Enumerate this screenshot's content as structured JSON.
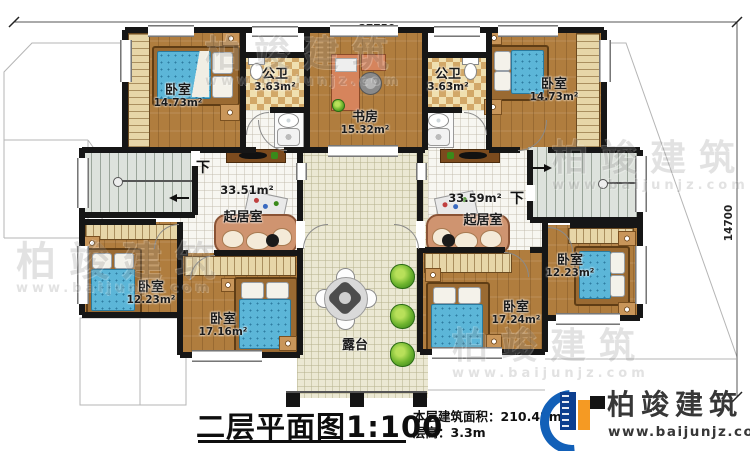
{
  "dimensions": {
    "width_mm": "27750",
    "height_mm": "14700"
  },
  "rooms": {
    "bedroom_top_left": {
      "name": "卧室",
      "area": "14.73m²"
    },
    "bath_left": {
      "name": "公卫",
      "area": "3.63m²"
    },
    "study": {
      "name": "书房",
      "area": "15.32m²"
    },
    "bath_right": {
      "name": "公卫",
      "area": "3.63m²"
    },
    "bedroom_top_right": {
      "name": "卧室",
      "area": "14.73m²"
    },
    "living_left": {
      "name": "起居室",
      "area": "33.51m²"
    },
    "living_right": {
      "name": "起居室",
      "area": "33.59m²"
    },
    "bedroom_left": {
      "name": "卧室",
      "area": "12.23m²"
    },
    "bedroom_bottom_left": {
      "name": "卧室",
      "area": "17.16m²"
    },
    "bedroom_bottom_right": {
      "name": "卧室",
      "area": "17.24m²"
    },
    "bedroom_right": {
      "name": "卧室",
      "area": "12.23m²"
    },
    "terrace": {
      "name": "露台"
    }
  },
  "stairs": {
    "down_label": "下"
  },
  "title": {
    "text": "二层平面图",
    "scale": "1:100"
  },
  "info": {
    "area_label": "本层建筑面积：",
    "area_value": "210.42m²",
    "height_label": "层高：",
    "height_value": "3.3m"
  },
  "logo": {
    "name": "柏竣建筑",
    "website": "www.baijunjz.com"
  },
  "watermark": {
    "name": "柏竣建筑",
    "website": "www.baijunjz.com"
  }
}
